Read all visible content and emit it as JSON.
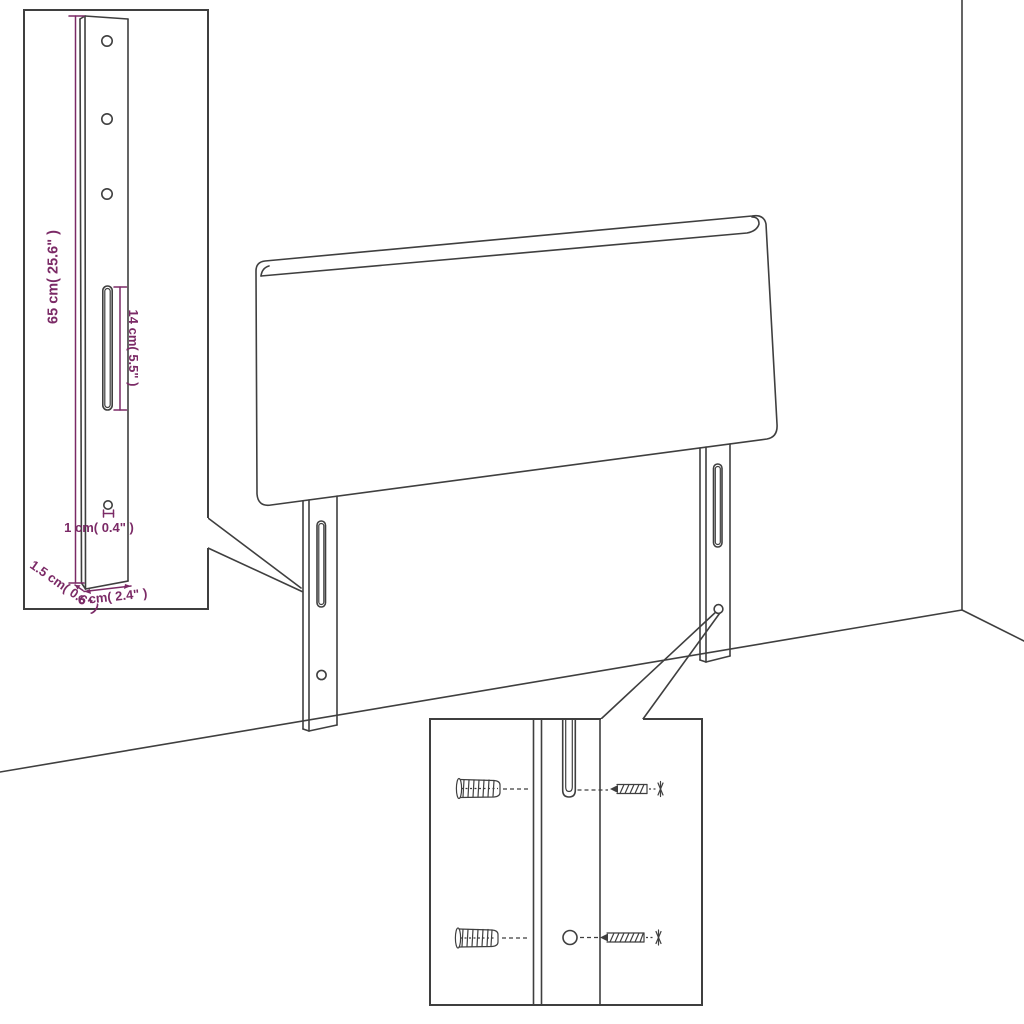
{
  "diagram": {
    "colors": {
      "line": "#3f3f3f",
      "dimension": "#7b2a66",
      "background": "#ffffff"
    },
    "leg_detail_inset": {
      "dim_height": "65 cm( 25.6\" )",
      "dim_slot_length": "14 cm( 5.5\" )",
      "dim_hole_diameter": "1 cm( 0.4\" )",
      "dim_thickness": "1.5 cm( 0.6\" )",
      "dim_width": "6 cm( 2.4\" )"
    },
    "mounting_inset": {
      "hardware": [
        "wall-plug",
        "screw",
        "wall-plug",
        "screw"
      ]
    }
  }
}
